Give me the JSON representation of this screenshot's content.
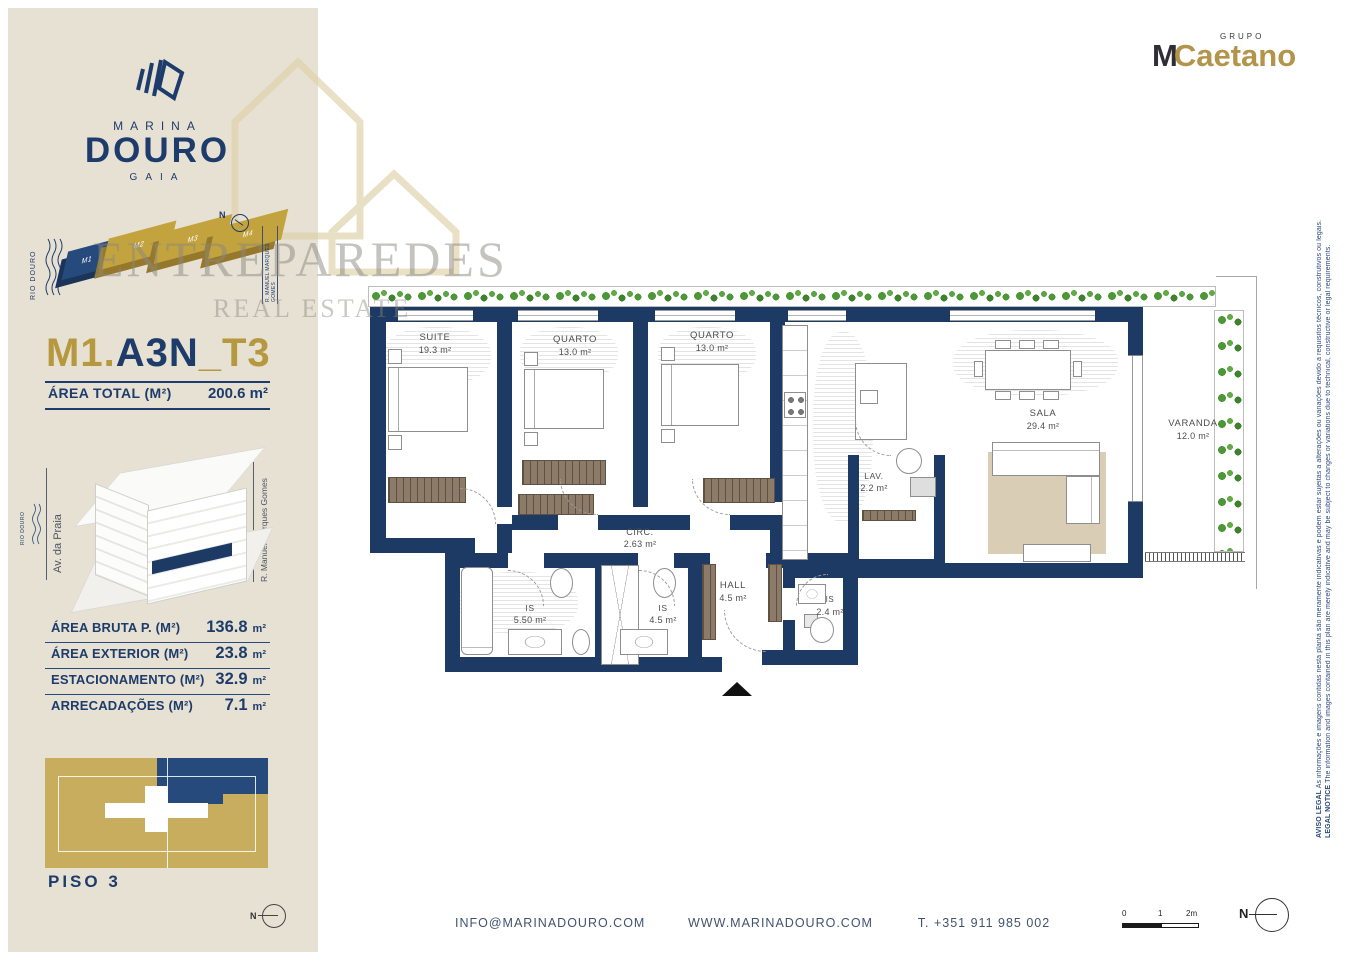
{
  "brand": {
    "marina": "MARINA",
    "douro": "DOURO",
    "gaia": "GAIA"
  },
  "group_logo": {
    "grupo": "GRUPO",
    "m": "M",
    "caetano": "Caetano"
  },
  "compass_n": "N",
  "site_plan": {
    "river": "RIO DOURO",
    "blocks": [
      "M1",
      "M2",
      "M3",
      "M4"
    ],
    "street": "R. MANUEL MARQUES GOMES"
  },
  "unit_title": {
    "m1": "M1.",
    "a3n": "A3N",
    "sep": "_",
    "t3": "T3"
  },
  "area_total": {
    "label": "ÁREA TOTAL  (M²)",
    "value": "200.6 m²"
  },
  "building_key": {
    "street_left": "Av. da Praia",
    "street_right": "R. Manuel Marques Gomes",
    "river": "RIO DOURO"
  },
  "areas": [
    {
      "label": "ÁREA BRUTA P.  (M²)",
      "value": "136.8",
      "unit": "m²"
    },
    {
      "label": "ÁREA EXTERIOR (M²)",
      "value": "23.8",
      "unit": "m²"
    },
    {
      "label": "ESTACIONAMENTO (M²)",
      "value": "32.9",
      "unit": "m²"
    },
    {
      "label": "ARRECADAÇÕES (M²)",
      "value": "7.1",
      "unit": "m²"
    }
  ],
  "floor_key": {
    "label": "PISO 3"
  },
  "floorplan": {
    "rooms": [
      {
        "name": "SUITE",
        "area": "19.3 m²"
      },
      {
        "name": "QUARTO",
        "area": "13.0 m²"
      },
      {
        "name": "QUARTO",
        "area": "13.0 m²"
      },
      {
        "name": "SALA",
        "area": "29.4 m²"
      },
      {
        "name": "VARANDA",
        "area": "12.0 m²"
      },
      {
        "name": "LAV.",
        "area": "2.2 m²"
      },
      {
        "name": "CIRC.",
        "area": "2.63 m²"
      },
      {
        "name": "HALL",
        "area": "4.5 m²"
      },
      {
        "name": "IS",
        "area": "5.50 m²"
      },
      {
        "name": "IS",
        "area": "4.5 m²"
      },
      {
        "name": "IS",
        "area": "2.4 m²"
      }
    ]
  },
  "watermark": {
    "line1": "ENTREPAREDES",
    "line2": "REAL ESTATE"
  },
  "footer": {
    "email": "INFO@MARINADOURO.COM",
    "website": "WWW.MARINADOURO.COM",
    "phone": "T. +351 911 985 002",
    "scale_0": "0",
    "scale_1": "1",
    "scale_2": "2m"
  },
  "legal": {
    "pt_label": "AVISO LEGAL",
    "pt_text": " As informações e imagens contidas nesta planta são meramente indicativas e podem estar sujeitas a alterações ou variações devido a requisitos técnicos, construtivos ou legais.",
    "en_label": "LEGAL NOTICE",
    "en_text": " The information and images contained in this plan are merely indicative and may be subject to changes or variations due to technical, constructive or legal requirements."
  },
  "colors": {
    "navy": "#1d3c6b",
    "gold": "#b6983f",
    "beige": "#e7e1d3",
    "wall": "#1d3a64",
    "hedge_green": "#4e9739",
    "wardrobe_brown": "#8c7b68",
    "rug": "#d9cdb6"
  }
}
